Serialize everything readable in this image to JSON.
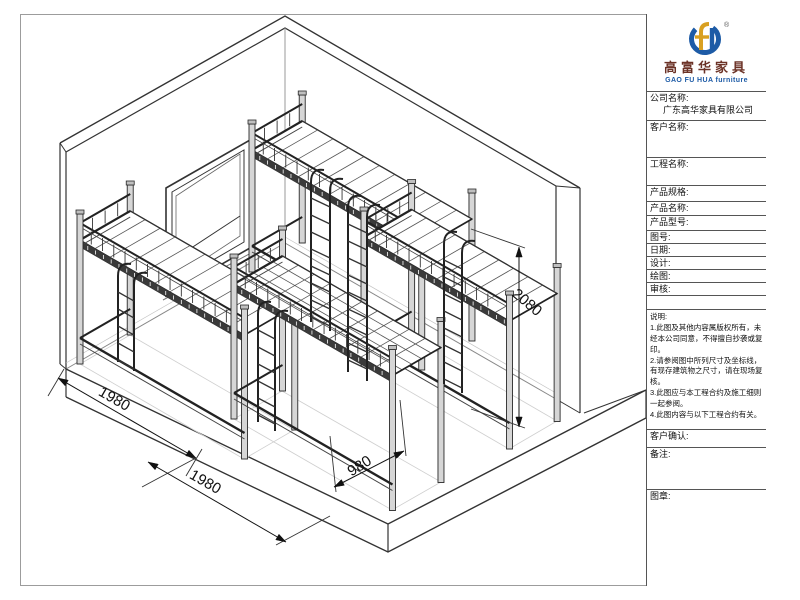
{
  "brand": {
    "logo_cn": "高富华家具",
    "logo_en": "GAO FU HUA furniture",
    "registered_mark": "®",
    "colors": {
      "blue": "#1d5ba6",
      "gold": "#d9a021",
      "dark_red": "#6b3226"
    }
  },
  "title_block": {
    "company_label": "公司名称:",
    "company_value": "广东高华家具有限公司",
    "customer_label": "客户名称:",
    "project_label": "工程名称:",
    "spec_label": "产品规格:",
    "product_name_label": "产品名称:",
    "model_label": "产品型号:",
    "drawing_no_label": "图号:",
    "date_label": "日期:",
    "design_label": "设计:",
    "draft_label": "绘图:",
    "review_label": "审核:",
    "notes_title": "说明:",
    "notes": [
      "1.此图及其他内容属版权所有，未经本公司同意，不得擅自抄袭或复印。",
      "2.请参阅图中所列尺寸及坐标线，有现存建筑物之尺寸，请在现场复核。",
      "3.此图应与本工程合约及施工细则一起参阅。",
      "4.此图内容与以下工程合约有关。"
    ],
    "confirm_label": "客户确认:",
    "remarks_label": "备注:",
    "stamp_label": "图章:"
  },
  "drawing": {
    "dimensions": {
      "bay1": "1980",
      "bay2": "1980",
      "depth": "980",
      "height": "2080"
    }
  }
}
